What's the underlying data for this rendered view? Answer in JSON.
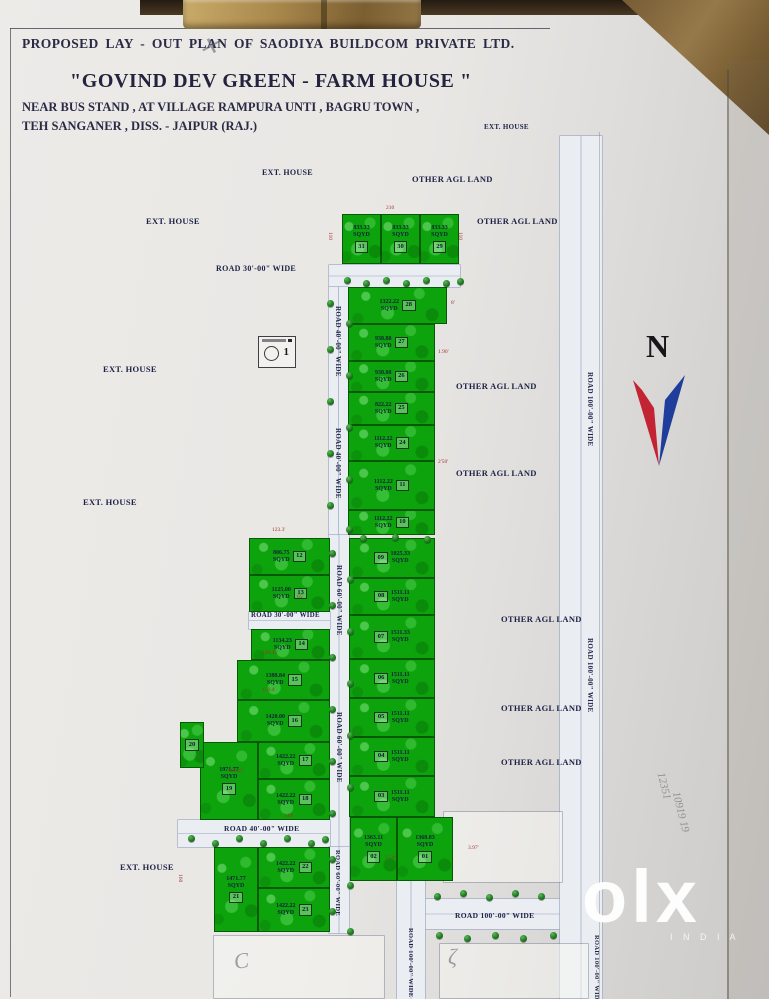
{
  "header": {
    "line1": "PROPOSED LAY - OUT PLAN OF SAODIYA BUILDCOM  PRIVATE LTD.",
    "title": "\"GOVIND DEV GREEN - FARM HOUSE \"",
    "line3": "NEAR BUS STAND , AT VILLAGE RAMPURA UNTI , BAGRU TOWN ,",
    "line4": "TEH SANGANER , DISS. - JAIPUR    (RAJ.)"
  },
  "compass": {
    "label": "N"
  },
  "stamp": {
    "mark": "1"
  },
  "watermark": {
    "brand": "olx",
    "sub": "I N D I A"
  },
  "colors": {
    "plot_green": "#0ca30c",
    "road_fill": "#eaedf2",
    "ink": "#1c2145",
    "dim_red": "#a23430",
    "north_red": "#c32433",
    "north_blue": "#1f3e9c"
  },
  "map": {
    "unit": "SQYD",
    "roads": [
      {
        "x": 329,
        "y": 265,
        "w": 131,
        "h": 22
      },
      {
        "x": 329,
        "y": 287,
        "w": 19,
        "h": 248
      },
      {
        "x": 329,
        "y": 535,
        "w": 20,
        "h": 312
      },
      {
        "x": 249,
        "y": 612,
        "w": 81,
        "h": 17
      },
      {
        "x": 178,
        "y": 820,
        "w": 152,
        "h": 27
      },
      {
        "x": 329,
        "y": 847,
        "w": 20,
        "h": 86
      },
      {
        "x": 420,
        "y": 899,
        "w": 176,
        "h": 30
      },
      {
        "x": 560,
        "y": 136,
        "w": 42,
        "h": 863
      },
      {
        "x": 397,
        "y": 881,
        "w": 28,
        "h": 118
      }
    ],
    "outlines": [
      {
        "x": 214,
        "y": 936,
        "w": 170,
        "h": 62
      },
      {
        "x": 440,
        "y": 944,
        "w": 148,
        "h": 54
      },
      {
        "x": 444,
        "y": 812,
        "w": 118,
        "h": 70
      }
    ],
    "plots": [
      {
        "n": "31",
        "a": "833.33",
        "x": 342,
        "y": 214,
        "w": 39,
        "h": 50
      },
      {
        "n": "30",
        "a": "833.33",
        "x": 381,
        "y": 214,
        "w": 39,
        "h": 50
      },
      {
        "n": "29",
        "a": "833.33",
        "x": 420,
        "y": 214,
        "w": 39,
        "h": 50
      },
      {
        "n": "28",
        "a": "1322.22",
        "x": 348,
        "y": 287,
        "w": 99,
        "h": 37
      },
      {
        "n": "27",
        "a": "938.88",
        "x": 348,
        "y": 324,
        "w": 87,
        "h": 37
      },
      {
        "n": "26",
        "a": "938.88",
        "x": 348,
        "y": 361,
        "w": 87,
        "h": 31
      },
      {
        "n": "25",
        "a": "822.22",
        "x": 348,
        "y": 392,
        "w": 87,
        "h": 33
      },
      {
        "n": "24",
        "a": "1112.22",
        "x": 348,
        "y": 425,
        "w": 87,
        "h": 36
      },
      {
        "n": "11",
        "a": "1112.22",
        "x": 348,
        "y": 461,
        "w": 87,
        "h": 49
      },
      {
        "n": "10",
        "a": "1112.22",
        "x": 348,
        "y": 510,
        "w": 87,
        "h": 25
      },
      {
        "n": "12",
        "a": "806.75",
        "x": 249,
        "y": 538,
        "w": 81,
        "h": 37
      },
      {
        "n": "13",
        "a": "1125.00",
        "x": 249,
        "y": 575,
        "w": 81,
        "h": 37
      },
      {
        "n": "14",
        "a": "1134.23",
        "x": 251,
        "y": 629,
        "w": 79,
        "h": 31
      },
      {
        "n": "15",
        "a": "1388.84",
        "x": 237,
        "y": 660,
        "w": 93,
        "h": 40
      },
      {
        "n": "16",
        "a": "1420.00",
        "x": 237,
        "y": 700,
        "w": 93,
        "h": 42
      },
      {
        "n": "17",
        "a": "1422.22",
        "x": 258,
        "y": 742,
        "w": 72,
        "h": 37
      },
      {
        "n": "18",
        "a": "1422.22",
        "x": 258,
        "y": 779,
        "w": 72,
        "h": 41
      },
      {
        "n": "19",
        "a": "1971.77",
        "x": 200,
        "y": 742,
        "w": 58,
        "h": 78
      },
      {
        "n": "20",
        "a": "",
        "x": 180,
        "y": 722,
        "w": 24,
        "h": 46
      },
      {
        "n": "21",
        "a": "1471.77",
        "x": 214,
        "y": 847,
        "w": 44,
        "h": 85
      },
      {
        "n": "22",
        "a": "1422.22",
        "x": 258,
        "y": 847,
        "w": 72,
        "h": 41
      },
      {
        "n": "23",
        "a": "1422.22",
        "x": 258,
        "y": 888,
        "w": 72,
        "h": 44
      },
      {
        "n": "09",
        "a": "1025.33",
        "x": 349,
        "y": 538,
        "w": 86,
        "h": 40,
        "o": 1
      },
      {
        "n": "08",
        "a": "1511.11",
        "x": 349,
        "y": 578,
        "w": 86,
        "h": 37,
        "o": 1
      },
      {
        "n": "07",
        "a": "1511.33",
        "x": 349,
        "y": 615,
        "w": 86,
        "h": 44,
        "o": 1
      },
      {
        "n": "06",
        "a": "1511.11",
        "x": 349,
        "y": 659,
        "w": 86,
        "h": 39,
        "o": 1
      },
      {
        "n": "05",
        "a": "1511.11",
        "x": 349,
        "y": 698,
        "w": 86,
        "h": 39,
        "o": 1
      },
      {
        "n": "04",
        "a": "1511.11",
        "x": 349,
        "y": 737,
        "w": 86,
        "h": 39,
        "o": 1
      },
      {
        "n": "03",
        "a": "1511.11",
        "x": 349,
        "y": 776,
        "w": 86,
        "h": 41,
        "o": 1
      },
      {
        "n": "02",
        "a": "1363.11",
        "x": 350,
        "y": 817,
        "w": 47,
        "h": 64
      },
      {
        "n": "01",
        "a": "1360.83",
        "x": 397,
        "y": 817,
        "w": 56,
        "h": 64
      }
    ],
    "labels": [
      {
        "t": "EXT. HOUSE",
        "x": 484,
        "y": 123,
        "s": 7
      },
      {
        "t": "EXT. HOUSE",
        "x": 262,
        "y": 168,
        "s": 8
      },
      {
        "t": "OTHER AGL LAND",
        "x": 412,
        "y": 174,
        "s": 8.5
      },
      {
        "t": "EXT. HOUSE",
        "x": 146,
        "y": 216,
        "s": 8.5
      },
      {
        "t": "OTHER AGL LAND",
        "x": 477,
        "y": 216,
        "s": 8.5
      },
      {
        "t": "ROAD 30'-00\" WIDE",
        "x": 216,
        "y": 264,
        "s": 8
      },
      {
        "t": "EXT. HOUSE",
        "x": 103,
        "y": 364,
        "s": 8.5
      },
      {
        "t": "OTHER AGL LAND",
        "x": 456,
        "y": 381,
        "s": 8.5
      },
      {
        "t": "OTHER AGL LAND",
        "x": 456,
        "y": 468,
        "s": 8.5
      },
      {
        "t": "EXT. HOUSE",
        "x": 83,
        "y": 497,
        "s": 8.5
      },
      {
        "t": "OTHER AGL LAND",
        "x": 501,
        "y": 614,
        "s": 8.5
      },
      {
        "t": "OTHER AGL LAND",
        "x": 501,
        "y": 703,
        "s": 8.5
      },
      {
        "t": "OTHER AGL LAND",
        "x": 501,
        "y": 757,
        "s": 8.5
      },
      {
        "t": "EXT. HOUSE",
        "x": 120,
        "y": 862,
        "s": 8.5
      },
      {
        "t": "ROAD 30'-00\" WIDE",
        "x": 251,
        "y": 612,
        "s": 6.8
      },
      {
        "t": "ROAD 40'-00\" WIDE",
        "x": 224,
        "y": 824,
        "s": 7.5
      },
      {
        "t": "ROAD 100'-00\" WIDE",
        "x": 455,
        "y": 911,
        "s": 7.5
      },
      {
        "t": "ROAD 40'-00\" WIDE",
        "x": 342,
        "y": 306,
        "r": 90,
        "s": 7
      },
      {
        "t": "ROAD 40'-00\" WIDE",
        "x": 342,
        "y": 428,
        "r": 90,
        "s": 7
      },
      {
        "t": "ROAD 60'-00\" WIDE",
        "x": 343,
        "y": 565,
        "r": 90,
        "s": 7
      },
      {
        "t": "ROAD 60'-00\" WIDE",
        "x": 343,
        "y": 712,
        "r": 90,
        "s": 7
      },
      {
        "t": "ROAD 60'-00\" WIDE",
        "x": 341,
        "y": 850,
        "r": 90,
        "s": 6.5
      },
      {
        "t": "ROAD 100'-00\" WIDE",
        "x": 594,
        "y": 372,
        "r": 90,
        "s": 7
      },
      {
        "t": "ROAD 100'-00\" WIDE",
        "x": 594,
        "y": 638,
        "r": 90,
        "s": 7
      },
      {
        "t": "ROAD 100'-00\" WIDE",
        "x": 414,
        "y": 928,
        "r": 90,
        "s": 6.5
      },
      {
        "t": "ROAD 100'-00\" WIDE",
        "x": 600,
        "y": 935,
        "r": 90,
        "s": 6.5
      }
    ],
    "dims": [
      {
        "t": "210",
        "x": 386,
        "y": 205
      },
      {
        "t": "110",
        "x": 333,
        "y": 232,
        "r": 90
      },
      {
        "t": "110",
        "x": 463,
        "y": 232,
        "r": 90
      },
      {
        "t": "8'",
        "x": 451,
        "y": 300
      },
      {
        "t": "1.90'",
        "x": 438,
        "y": 349
      },
      {
        "t": "2'50'",
        "x": 438,
        "y": 459
      },
      {
        "t": "123.3'",
        "x": 272,
        "y": 527
      },
      {
        "t": "65'",
        "x": 297,
        "y": 594
      },
      {
        "t": "149.45'",
        "x": 262,
        "y": 650
      },
      {
        "t": "150.4'",
        "x": 262,
        "y": 687
      },
      {
        "t": "202.11'",
        "x": 228,
        "y": 768
      },
      {
        "t": "140'",
        "x": 284,
        "y": 813
      },
      {
        "t": "160",
        "x": 183,
        "y": 874,
        "r": 90
      },
      {
        "t": "1.50'",
        "x": 385,
        "y": 855
      },
      {
        "t": "3.97'",
        "x": 468,
        "y": 845
      }
    ],
    "trees": [
      [
        344,
        277
      ],
      [
        363,
        280
      ],
      [
        383,
        277
      ],
      [
        403,
        280
      ],
      [
        423,
        277
      ],
      [
        443,
        280
      ],
      [
        457,
        278
      ],
      [
        327,
        300
      ],
      [
        346,
        320
      ],
      [
        327,
        346
      ],
      [
        346,
        372
      ],
      [
        327,
        398
      ],
      [
        346,
        424
      ],
      [
        327,
        450
      ],
      [
        346,
        476
      ],
      [
        327,
        502
      ],
      [
        346,
        526
      ],
      [
        329,
        550
      ],
      [
        347,
        576
      ],
      [
        329,
        602
      ],
      [
        347,
        628
      ],
      [
        329,
        654
      ],
      [
        347,
        680
      ],
      [
        329,
        706
      ],
      [
        347,
        732
      ],
      [
        329,
        758
      ],
      [
        347,
        784
      ],
      [
        329,
        810
      ],
      [
        329,
        856
      ],
      [
        347,
        882
      ],
      [
        329,
        908
      ],
      [
        347,
        928
      ],
      [
        188,
        835
      ],
      [
        212,
        840
      ],
      [
        236,
        835
      ],
      [
        260,
        840
      ],
      [
        284,
        835
      ],
      [
        308,
        840
      ],
      [
        322,
        836
      ],
      [
        434,
        893
      ],
      [
        460,
        890
      ],
      [
        486,
        894
      ],
      [
        512,
        890
      ],
      [
        538,
        893
      ],
      [
        436,
        932
      ],
      [
        464,
        935
      ],
      [
        492,
        932
      ],
      [
        520,
        935
      ],
      [
        550,
        932
      ],
      [
        360,
        535
      ],
      [
        392,
        534
      ],
      [
        424,
        536
      ]
    ],
    "notes": [
      {
        "t": "✕",
        "x": 199,
        "y": 32,
        "s": 24,
        "r": 10
      },
      {
        "t": "12351",
        "x": 650,
        "y": 780,
        "s": 11,
        "r": 76
      },
      {
        "t": "10919 19",
        "x": 660,
        "y": 806,
        "s": 11,
        "r": 76
      },
      {
        "t": "C",
        "x": 234,
        "y": 948,
        "s": 22,
        "r": -8
      },
      {
        "t": "ζ",
        "x": 448,
        "y": 944,
        "s": 22,
        "r": 0
      }
    ]
  }
}
